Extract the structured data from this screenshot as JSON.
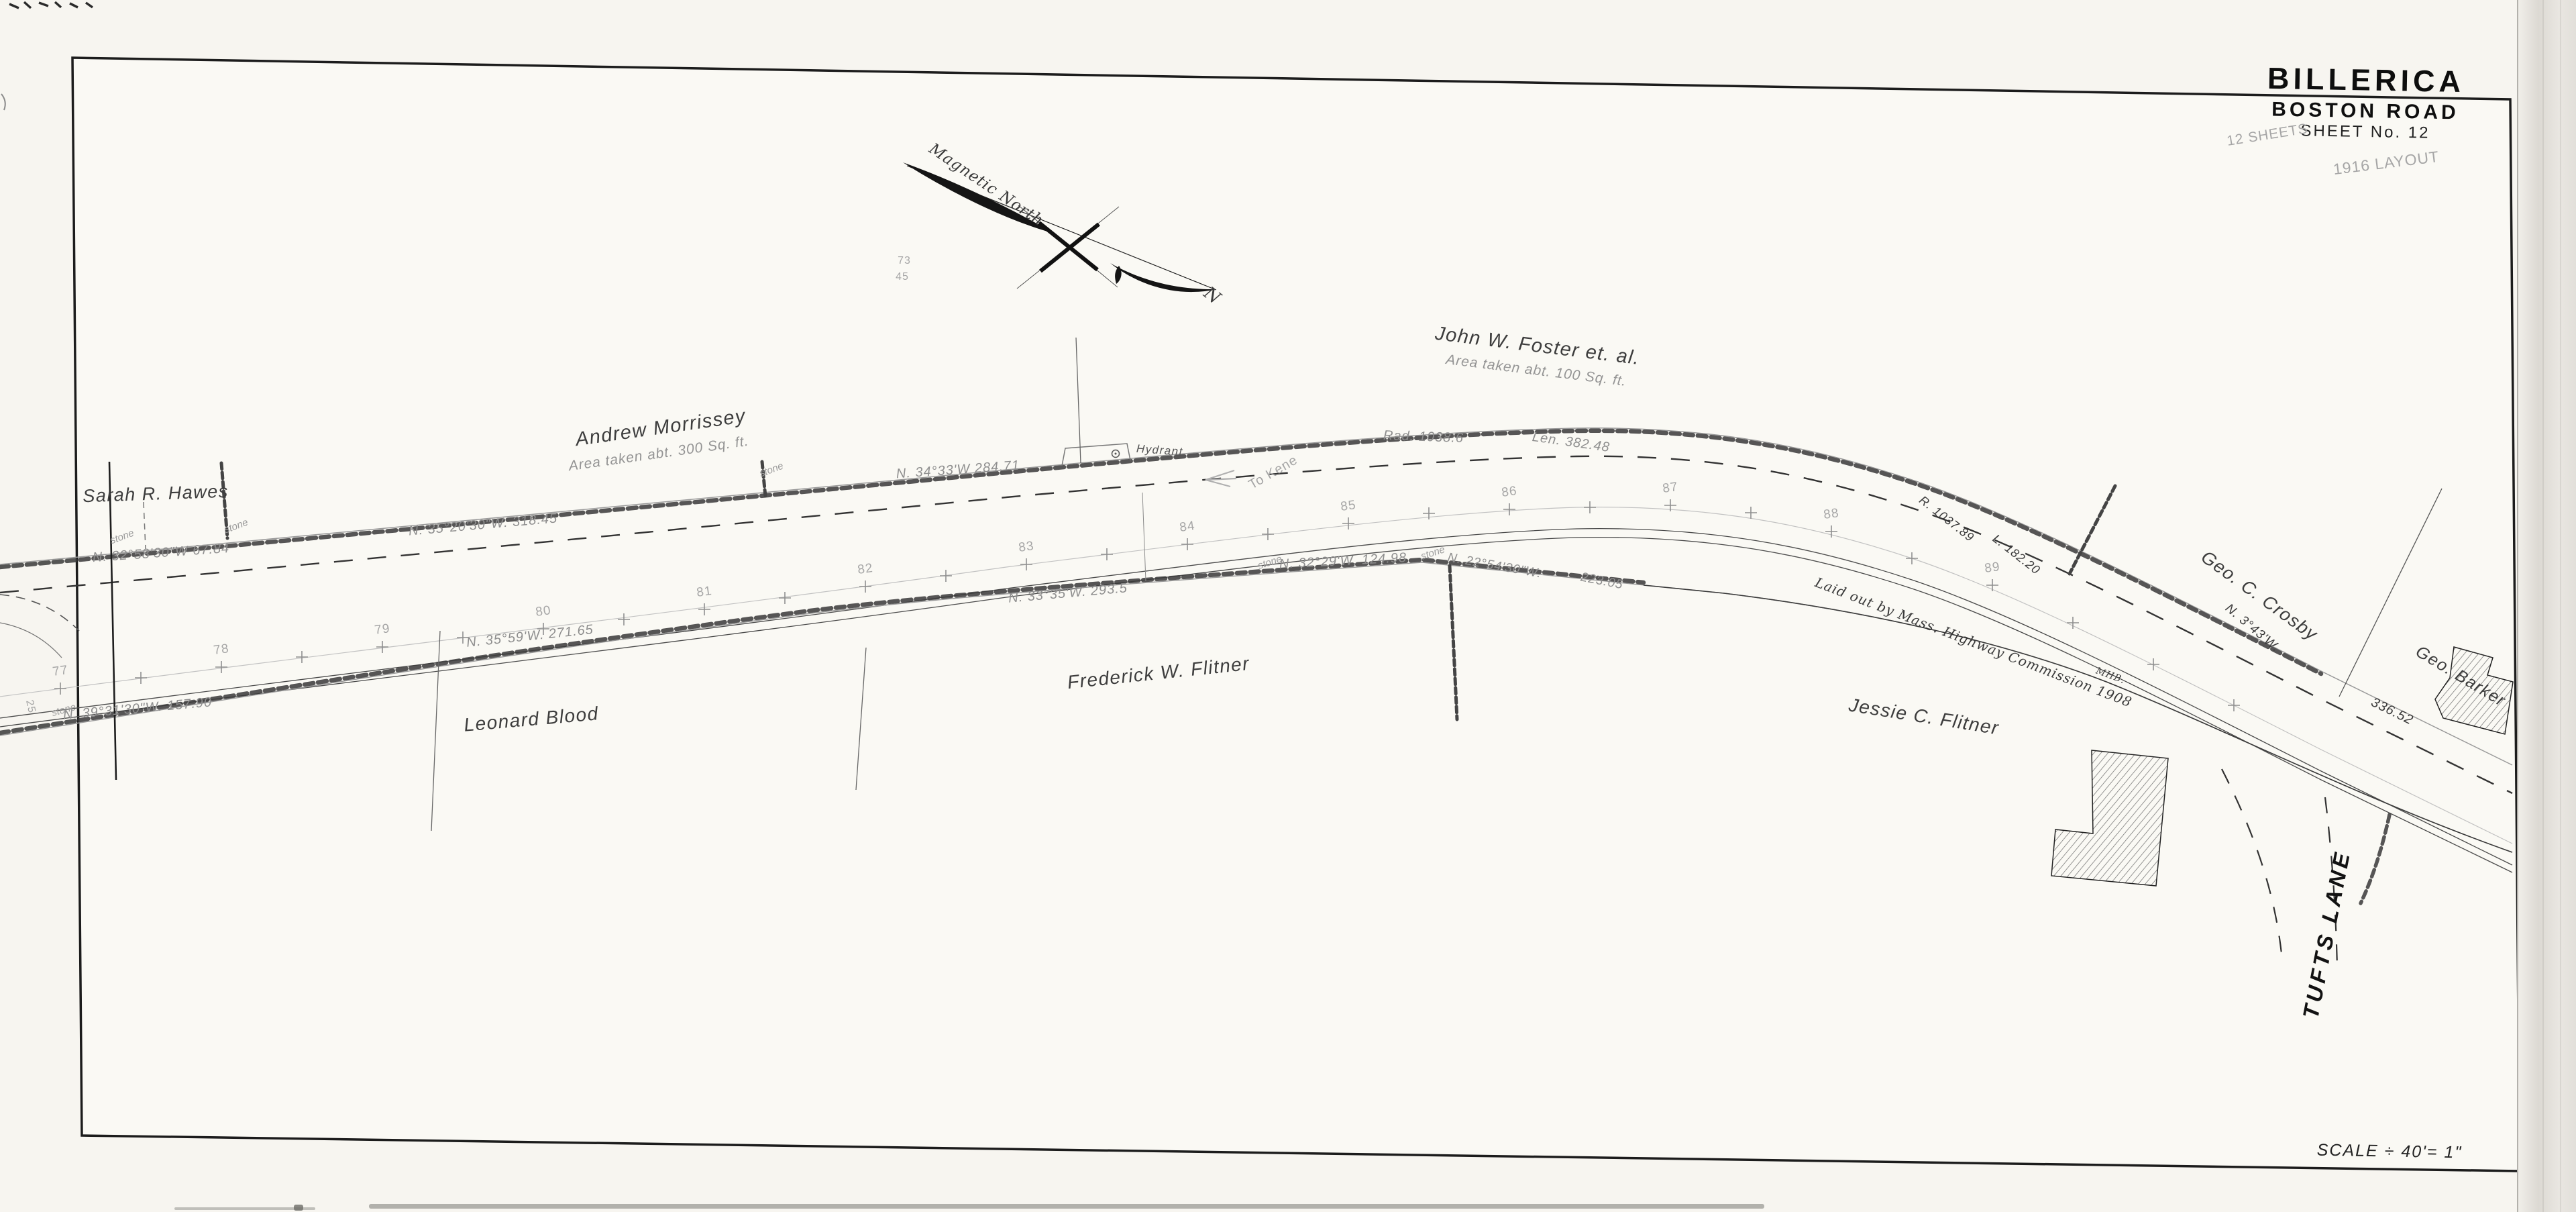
{
  "sheet": {
    "town": "BILLERICA",
    "road": "BOSTON ROAD",
    "sheet_no": "SHEET No. 12",
    "scale_note": "SCALE ÷ 40'= 1\""
  },
  "handwritten": {
    "sheets_note": "12 SHEETS",
    "layout_note": "1916 LAYOUT",
    "to_note": "To Kene",
    "fig_a": "73",
    "fig_b": "45",
    "fig_c": "25"
  },
  "north_arrow": {
    "label": "Magnetic North",
    "letter": "N"
  },
  "owners": {
    "hawes": "Sarah R. Hawes",
    "morrissey": "Andrew Morrissey",
    "morrissey_area": "Area taken abt. 300 Sq. ft.",
    "foster": "John W. Foster et. al.",
    "foster_area": "Area taken abt. 100 Sq. ft.",
    "crosby": "Geo. C. Crosby",
    "barker": "Geo. Barker",
    "blood": "Leonard Blood",
    "flitner_f": "Frederick W. Flitner",
    "flitner_j": "Jessie C. Flitner"
  },
  "bearings": {
    "b1": "N. 32°58'30\"W  67.84",
    "b2": "N. 35°20'30\"W.  318.45",
    "b3": "N. 34°33'W  284.71",
    "b4": "Rad. 1038.6",
    "b5": "Len. 382.48",
    "b6": "R. 1037.89",
    "b7": "L. 182.20",
    "b8": "N. 3°43'W.",
    "b9": "336.52",
    "b10": "N. 39°31'30\"W.  157.90",
    "b11": "N. 35°59'W.  271.65",
    "b12": "N. 33°35'W.  293.5",
    "b13": "N. 32°29'W.  124.98",
    "b14": "N. 22°54'30\"W.",
    "b15": "223.05"
  },
  "notes": {
    "laid_out": "Laid out by Mass. Highway Commission 1908",
    "mhb": "MHB.",
    "hydrant": "Hydrant.",
    "stone": "stone",
    "tufts": "TUFTS LANE"
  },
  "stations": [
    "77",
    "78",
    "79",
    "80",
    "81",
    "82",
    "83",
    "84",
    "85",
    "86",
    "87",
    "88",
    "89"
  ]
}
